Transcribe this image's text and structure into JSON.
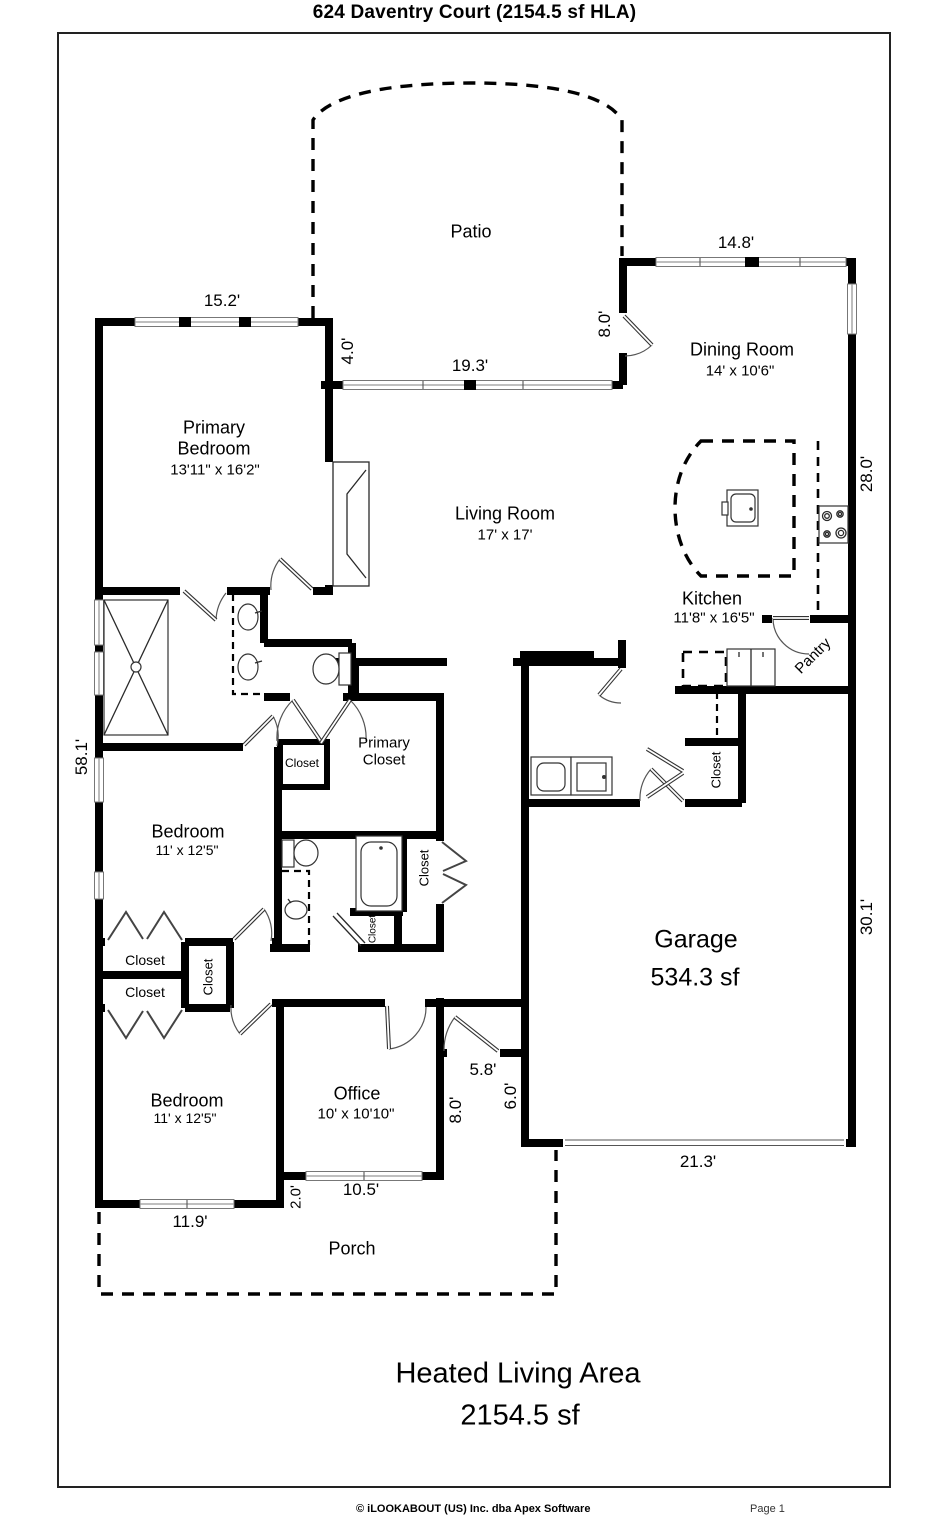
{
  "page": {
    "title": "624 Daventry Court (2154.5 sf HLA)"
  },
  "summary": {
    "line1": "Heated Living Area",
    "line2": "2154.5 sf"
  },
  "footer": {
    "copyright": "© iLOOKABOUT (US) Inc. dba Apex Software",
    "page": "Page 1"
  },
  "rooms": {
    "patio": {
      "name": "Patio"
    },
    "dining": {
      "name": "Dining Room",
      "dims": "14' x 10'6\""
    },
    "primary_bedroom": {
      "line1": "Primary",
      "line2": "Bedroom",
      "dims": "13'11\" x 16'2\""
    },
    "living": {
      "name": "Living Room",
      "dims": "17' x 17'"
    },
    "kitchen": {
      "name": "Kitchen",
      "dims": "11'8\" x 16'5\""
    },
    "pantry": {
      "name": "Pantry"
    },
    "primary_closet": {
      "line1": "Primary",
      "line2": "Closet"
    },
    "bedroom_upper": {
      "name": "Bedroom",
      "dims": "11' x 12'5\""
    },
    "bedroom_lower": {
      "name": "Bedroom",
      "dims": "11' x 12'5\""
    },
    "office": {
      "name": "Office",
      "dims": "10' x 10'10\""
    },
    "garage": {
      "name": "Garage",
      "area": "534.3 sf"
    },
    "porch": {
      "name": "Porch"
    },
    "closet_label": "Closet"
  },
  "dimensions": {
    "dining_top": "14.8'",
    "patio_right": "8.0'",
    "patio_left_jog": "4.0'",
    "living_north": "19.3'",
    "primary_top": "15.2'",
    "east_upper": "28.0'",
    "west_side": "58.1'",
    "garage_east": "30.1'",
    "entry_width": "5.8'",
    "entry_left": "8.0'",
    "entry_right": "6.0'",
    "office_jog": "2.0'",
    "office_south": "10.5'",
    "bedroom_south": "11.9'",
    "garage_south": "21.3'"
  }
}
